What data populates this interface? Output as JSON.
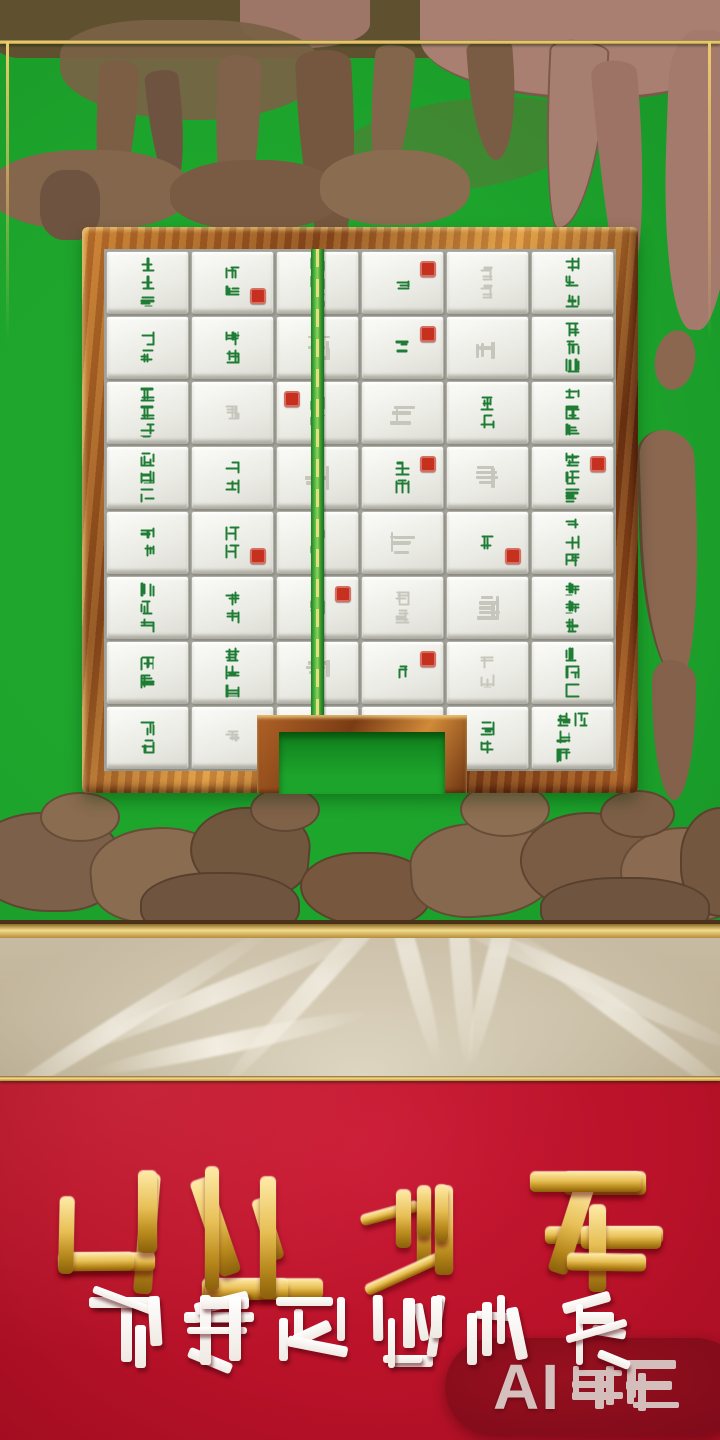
{
  "scene": {
    "description": "AI-generated mahjong-solitaire game promo screen",
    "style_note": "all calligraphy on screen is garbled pseudo-Chinese"
  },
  "colors": {
    "table_green": "#1da42c",
    "frame_bronze": "#a55a22",
    "gold_accent": "#f3dc8a",
    "silk_beige": "#cfc3aa",
    "banner_red": "#b91229",
    "tile_glyph_green": "#1f7c35",
    "seal_red": "#c5301f",
    "watermark_pill_red": "#7e0b1a",
    "watermark_text": "#d8cac6"
  },
  "title": {
    "text": "醺雀二 余",
    "style": "gold embossed garbled calligraphy",
    "glyph_sizes": [
      132,
      136,
      104,
      138
    ]
  },
  "subtitle": {
    "text": "洒写筅金希哚",
    "style": "white rounded garbled calligraphy",
    "glyph_size": 74
  },
  "watermark": {
    "full": "AI生成",
    "latin": "AI",
    "cjk": "生成",
    "glyph_size": 54
  },
  "board": {
    "grid": {
      "cols": 6,
      "rows": 8
    },
    "bamboo_divider": "vertical green bamboo stick between columns 2 and 3",
    "notch": "open slot cut through bottom-center frame",
    "tiles": [
      {
        "g": "萬萬筒",
        "s": 0,
        "f": 0
      },
      {
        "g": "條萬",
        "s": 1,
        "f": 0
      },
      {
        "g": "發發筒",
        "s": 0,
        "f": 0
      },
      {
        "g": "中",
        "s": 1,
        "f": 0
      },
      {
        "g": "三三",
        "s": 0,
        "f": 1
      },
      {
        "g": "萬條發",
        "s": 0,
        "f": 0
      },
      {
        "g": "筒條",
        "s": 0,
        "f": 0
      },
      {
        "g": "萬發",
        "s": 0,
        "f": 0
      },
      {
        "g": "",
        "s": 0,
        "f": 1
      },
      {
        "g": "條",
        "s": 1,
        "f": 0
      },
      {
        "g": "",
        "s": 0,
        "f": 1
      },
      {
        "g": "發條萬",
        "s": 0,
        "f": 0
      },
      {
        "g": "條條萬",
        "s": 0,
        "f": 0
      },
      {
        "g": "筒",
        "s": 0,
        "f": 1
      },
      {
        "g": "萬條",
        "s": 1,
        "f": 0
      },
      {
        "g": "",
        "s": 0,
        "f": 1
      },
      {
        "g": "發萬",
        "s": 0,
        "f": 0
      },
      {
        "g": "筒發條",
        "s": 0,
        "f": 0
      },
      {
        "g": "萬筒發",
        "s": 0,
        "f": 0
      },
      {
        "g": "條發",
        "s": 0,
        "f": 0
      },
      {
        "g": "",
        "s": 0,
        "f": 1
      },
      {
        "g": "中發",
        "s": 1,
        "f": 0
      },
      {
        "g": "",
        "s": 0,
        "f": 1
      },
      {
        "g": "條萬筒",
        "s": 1,
        "f": 0
      },
      {
        "g": "發條",
        "s": 0,
        "f": 0
      },
      {
        "g": "萬萬",
        "s": 1,
        "f": 0
      },
      {
        "g": "筒條",
        "s": 0,
        "f": 0
      },
      {
        "g": "",
        "s": 0,
        "f": 1
      },
      {
        "g": "中",
        "s": 1,
        "f": 0
      },
      {
        "g": "萬發筒",
        "s": 0,
        "f": 0
      },
      {
        "g": "條萬發",
        "s": 0,
        "f": 0
      },
      {
        "g": "筒萬",
        "s": 0,
        "f": 0
      },
      {
        "g": "發",
        "s": 1,
        "f": 0
      },
      {
        "g": "條筒",
        "s": 0,
        "f": 1
      },
      {
        "g": "",
        "s": 0,
        "f": 1
      },
      {
        "g": "發發條",
        "s": 0,
        "f": 0
      },
      {
        "g": "萬條",
        "s": 0,
        "f": 0
      },
      {
        "g": "發筒條",
        "s": 0,
        "f": 0
      },
      {
        "g": "",
        "s": 0,
        "f": 1
      },
      {
        "g": "萬",
        "s": 1,
        "f": 0
      },
      {
        "g": "條發",
        "s": 0,
        "f": 1
      },
      {
        "g": "筒條萬",
        "s": 0,
        "f": 0
      },
      {
        "g": "筒發",
        "s": 0,
        "f": 0
      },
      {
        "g": "條",
        "s": 0,
        "f": 1
      },
      {
        "g": "萬發",
        "s": 0,
        "f": 0
      },
      {
        "g": "",
        "s": 0,
        "f": 1
      },
      {
        "g": "發條",
        "s": 0,
        "f": 0
      },
      {
        "g": "萬筒發條",
        "s": 0,
        "f": 0
      }
    ]
  }
}
